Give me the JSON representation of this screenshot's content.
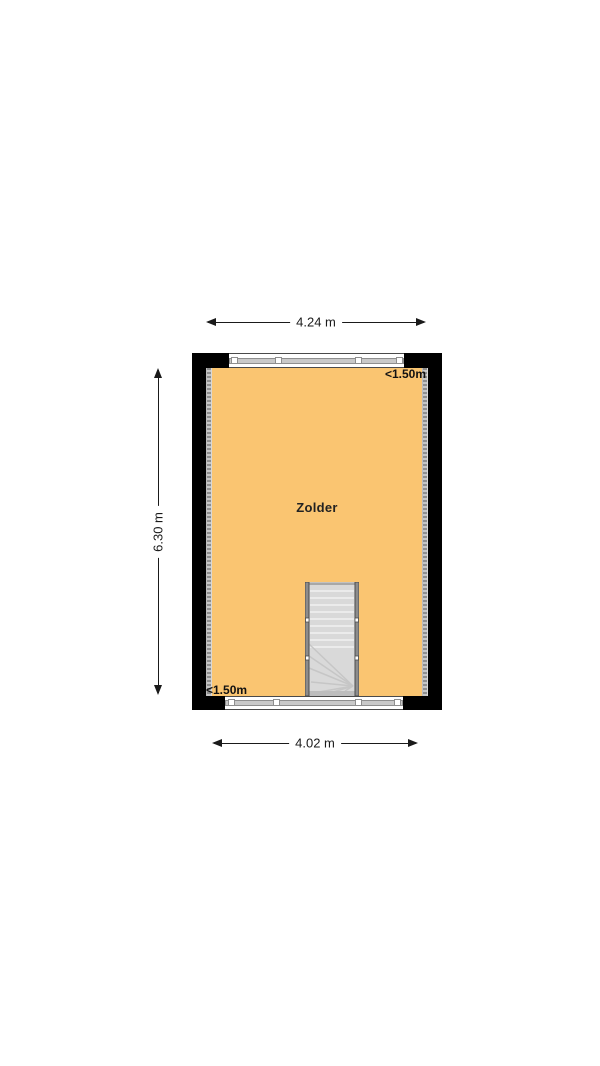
{
  "floorplan": {
    "room": {
      "label": "Zolder"
    },
    "dimensions": {
      "top_width": "4.24 m",
      "bottom_width": "4.02 m",
      "left_height": "6.30 m"
    },
    "ceiling_height_markers": {
      "top_right": "<1.50m",
      "bottom_left": "<1.50m"
    },
    "icons": {
      "arrowhead_left": "◄",
      "arrowhead_right": "►",
      "arrowhead_up": "▲",
      "arrowhead_down": "▼"
    },
    "colors": {
      "floor": "#FAC571",
      "wall": "#000000",
      "window_glass": "#C9C9C9",
      "stairs_fill": "#D9D9D9",
      "height_line": "#8E8E8E",
      "dimension": "#1A1A1A"
    }
  }
}
